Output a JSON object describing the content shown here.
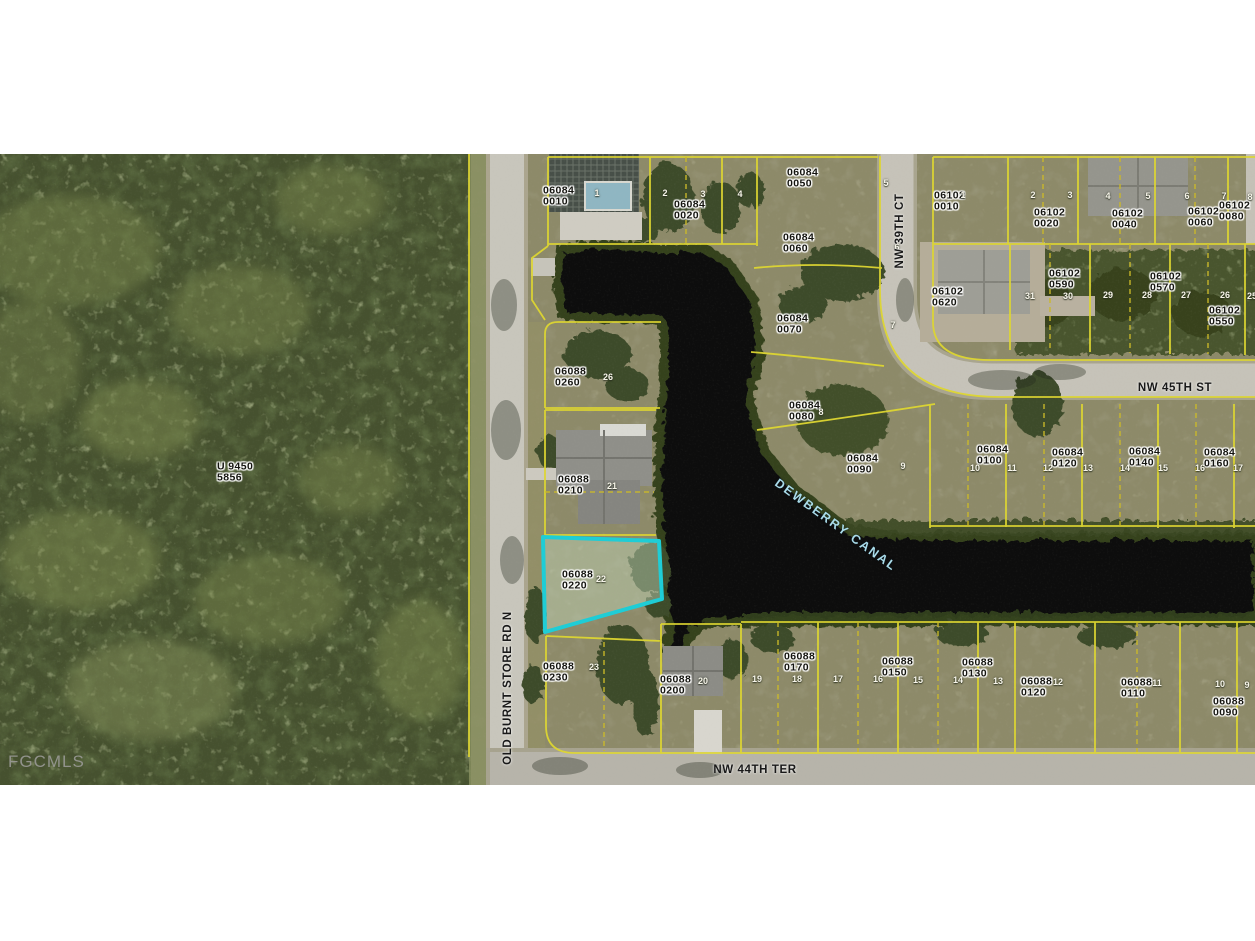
{
  "watermark": "FGCMLS",
  "map": {
    "colors": {
      "parcel_line_yellow": "#ded631",
      "subject_highlight_cyan": "#1ecdd6",
      "water_dark": "#0c0e10",
      "canal_text": "#aadcea",
      "label_text": "#14140f",
      "lot_number_text": "#f7f5ea"
    },
    "subject_parcel": {
      "id": "06088 0220",
      "lot": "22"
    },
    "street_labels": [
      {
        "text": "NW 45TH ST",
        "x": 1175,
        "y": 388,
        "rot": 0
      },
      {
        "text": "NW 39TH CT",
        "x": 900,
        "y": 231,
        "rot": -90
      },
      {
        "text": "NW 44TH TER",
        "x": 755,
        "y": 770,
        "rot": 0
      },
      {
        "text": "OLD BURNT STORE RD N",
        "x": 508,
        "y": 688,
        "rot": -90
      }
    ],
    "canal_label": {
      "text": "DEWBERRY CANAL",
      "x": 836,
      "y": 525,
      "rot": 36
    },
    "note_label": {
      "text": "U 9450 5856",
      "x": 240,
      "y": 473
    },
    "parcel_labels": [
      {
        "text": "06084 0010",
        "x": 566,
        "y": 197
      },
      {
        "text": "06084 0020",
        "x": 697,
        "y": 211
      },
      {
        "text": "06084 0050",
        "x": 810,
        "y": 179
      },
      {
        "text": "06084 0060",
        "x": 806,
        "y": 244
      },
      {
        "text": "06084 0070",
        "x": 800,
        "y": 325
      },
      {
        "text": "06084 0080",
        "x": 812,
        "y": 412
      },
      {
        "text": "06084 0090",
        "x": 870,
        "y": 465
      },
      {
        "text": "06084 0100",
        "x": 1000,
        "y": 456
      },
      {
        "text": "06084 0120",
        "x": 1075,
        "y": 459
      },
      {
        "text": "06084 0140",
        "x": 1152,
        "y": 458
      },
      {
        "text": "06084 0160",
        "x": 1227,
        "y": 459
      },
      {
        "text": "06102 0010",
        "x": 957,
        "y": 202
      },
      {
        "text": "06102 0020",
        "x": 1057,
        "y": 219
      },
      {
        "text": "06102 0040",
        "x": 1135,
        "y": 220
      },
      {
        "text": "06102 0060",
        "x": 1211,
        "y": 218
      },
      {
        "text": "06102 0080",
        "x": 1242,
        "y": 212
      },
      {
        "text": "06102 0620",
        "x": 955,
        "y": 298
      },
      {
        "text": "06102 0590",
        "x": 1072,
        "y": 280
      },
      {
        "text": "06102 0570",
        "x": 1173,
        "y": 283
      },
      {
        "text": "06102 0550",
        "x": 1232,
        "y": 317
      },
      {
        "text": "06088 0260",
        "x": 578,
        "y": 378
      },
      {
        "text": "06088 0210",
        "x": 581,
        "y": 486
      },
      {
        "text": "06088 0220",
        "x": 585,
        "y": 581
      },
      {
        "text": "06088 0230",
        "x": 566,
        "y": 673
      },
      {
        "text": "06088 0200",
        "x": 683,
        "y": 686
      },
      {
        "text": "06088 0170",
        "x": 807,
        "y": 663
      },
      {
        "text": "06088 0150",
        "x": 905,
        "y": 668
      },
      {
        "text": "06088 0130",
        "x": 985,
        "y": 669
      },
      {
        "text": "06088 0120",
        "x": 1044,
        "y": 688
      },
      {
        "text": "06088 0110",
        "x": 1144,
        "y": 689
      },
      {
        "text": "06088 0090",
        "x": 1236,
        "y": 708
      }
    ],
    "lot_numbers": [
      {
        "text": "1",
        "x": 597,
        "y": 193
      },
      {
        "text": "2",
        "x": 665,
        "y": 193
      },
      {
        "text": "3",
        "x": 703,
        "y": 194
      },
      {
        "text": "4",
        "x": 740,
        "y": 194
      },
      {
        "text": "5",
        "x": 886,
        "y": 183
      },
      {
        "text": "6",
        "x": 897,
        "y": 247
      },
      {
        "text": "7",
        "x": 893,
        "y": 325
      },
      {
        "text": "8",
        "x": 821,
        "y": 412
      },
      {
        "text": "9",
        "x": 903,
        "y": 466
      },
      {
        "text": "10",
        "x": 975,
        "y": 468
      },
      {
        "text": "11",
        "x": 1012,
        "y": 468
      },
      {
        "text": "12",
        "x": 1048,
        "y": 468
      },
      {
        "text": "13",
        "x": 1088,
        "y": 468
      },
      {
        "text": "14",
        "x": 1125,
        "y": 468
      },
      {
        "text": "15",
        "x": 1163,
        "y": 468
      },
      {
        "text": "16",
        "x": 1200,
        "y": 468
      },
      {
        "text": "17",
        "x": 1238,
        "y": 468
      },
      {
        "text": "1",
        "x": 963,
        "y": 195
      },
      {
        "text": "2",
        "x": 1033,
        "y": 195
      },
      {
        "text": "3",
        "x": 1070,
        "y": 195
      },
      {
        "text": "4",
        "x": 1108,
        "y": 196
      },
      {
        "text": "5",
        "x": 1148,
        "y": 196
      },
      {
        "text": "6",
        "x": 1187,
        "y": 196
      },
      {
        "text": "7",
        "x": 1224,
        "y": 196
      },
      {
        "text": "8",
        "x": 1250,
        "y": 197
      },
      {
        "text": "31",
        "x": 1030,
        "y": 296
      },
      {
        "text": "30",
        "x": 1068,
        "y": 296
      },
      {
        "text": "29",
        "x": 1108,
        "y": 295
      },
      {
        "text": "28",
        "x": 1147,
        "y": 295
      },
      {
        "text": "27",
        "x": 1186,
        "y": 295
      },
      {
        "text": "26",
        "x": 1225,
        "y": 295
      },
      {
        "text": "25",
        "x": 1252,
        "y": 296
      },
      {
        "text": "26",
        "x": 608,
        "y": 377
      },
      {
        "text": "21",
        "x": 612,
        "y": 486
      },
      {
        "text": "22",
        "x": 601,
        "y": 579
      },
      {
        "text": "23",
        "x": 594,
        "y": 667
      },
      {
        "text": "20",
        "x": 703,
        "y": 681
      },
      {
        "text": "19",
        "x": 757,
        "y": 679
      },
      {
        "text": "18",
        "x": 797,
        "y": 679
      },
      {
        "text": "17",
        "x": 838,
        "y": 679
      },
      {
        "text": "16",
        "x": 878,
        "y": 679
      },
      {
        "text": "15",
        "x": 918,
        "y": 680
      },
      {
        "text": "14",
        "x": 958,
        "y": 680
      },
      {
        "text": "13",
        "x": 998,
        "y": 681
      },
      {
        "text": "12",
        "x": 1058,
        "y": 682
      },
      {
        "text": "11",
        "x": 1157,
        "y": 683
      },
      {
        "text": "10",
        "x": 1220,
        "y": 684
      },
      {
        "text": "9",
        "x": 1247,
        "y": 685
      }
    ]
  }
}
